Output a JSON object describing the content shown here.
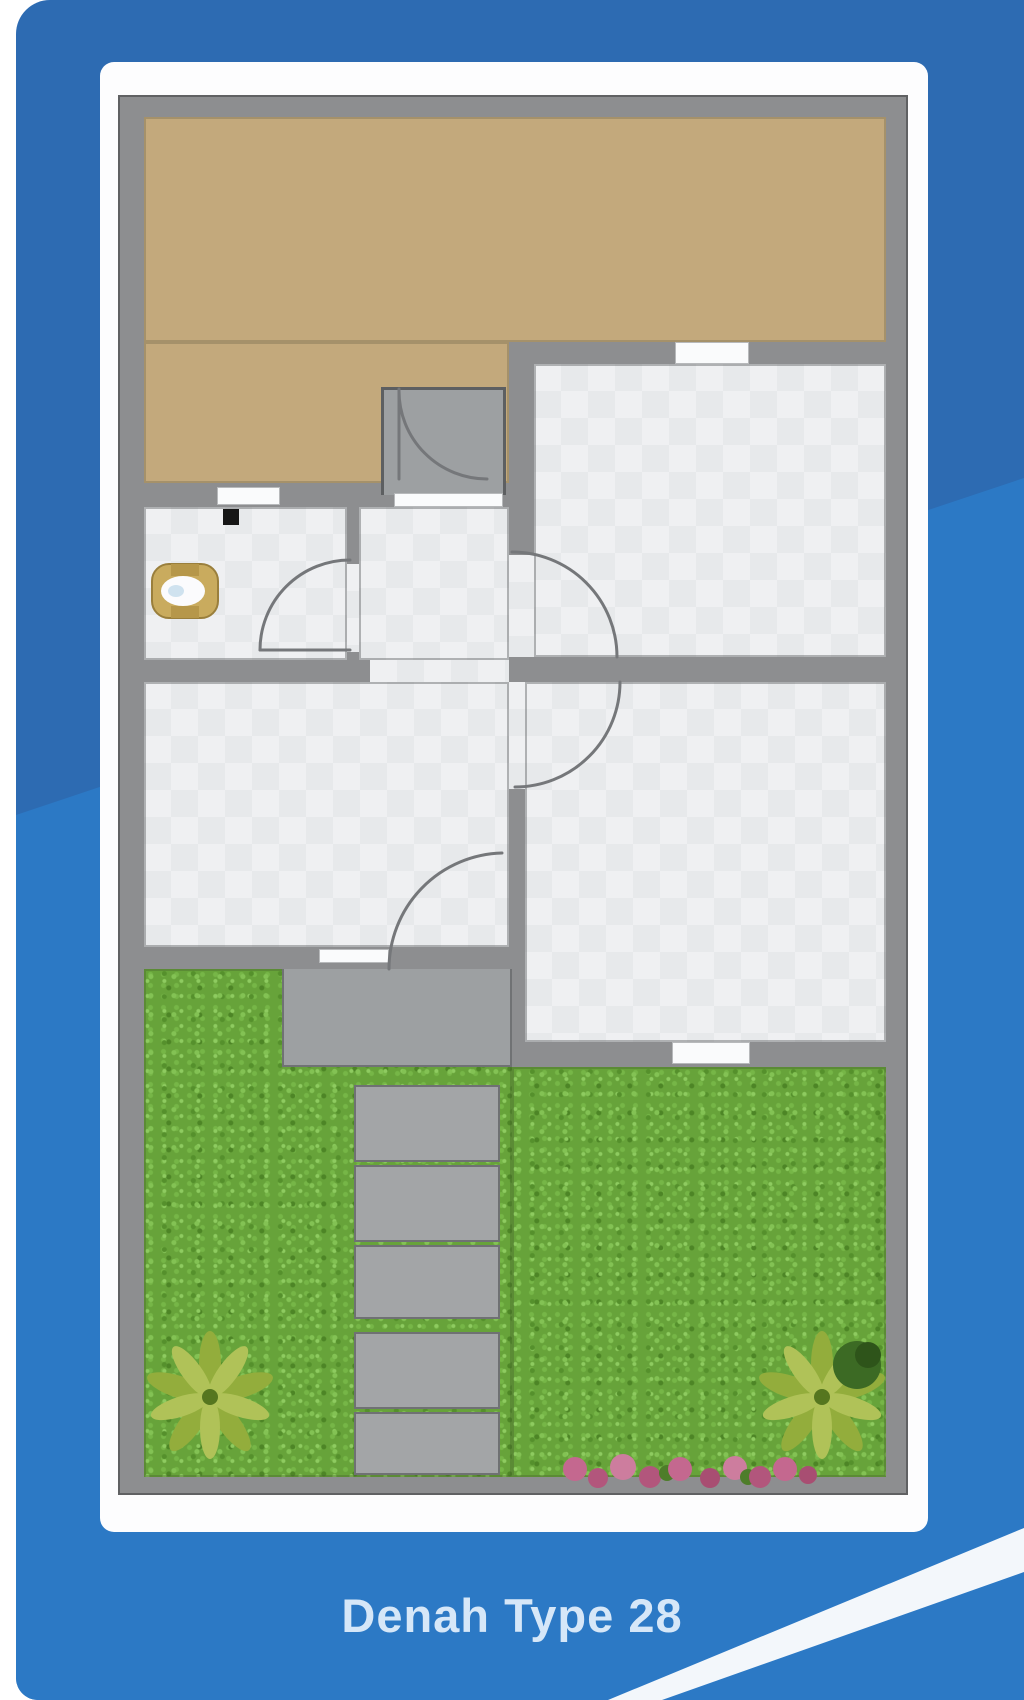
{
  "caption": {
    "label": "Denah Type 28"
  },
  "palette": {
    "background_blue_dark": "#2d6bb2",
    "background_blue_light": "#2c79c5",
    "swoosh_white": "#f3f7fb",
    "card_white": "#fdfdfe",
    "wall_gray": "#8d8e90",
    "wall_outline": "#606163",
    "carport_tan": "#c3a97c",
    "floor_tile": "#eff0f2",
    "porch_patio_gray": "#9da0a2",
    "stepping_stone_gray": "#a3a5a7",
    "grass_green": "#67a33a",
    "palm_green": "#9db544",
    "flower_pink": "#c4688f",
    "toilet_gold": "#c9ab5e",
    "caption_text": "#d6e7f8"
  },
  "plan": {
    "areas": [
      "carport",
      "porch",
      "bathroom",
      "hallway",
      "bedroom-top-right",
      "bedroom-bottom-right",
      "living-room",
      "patio",
      "garden-left",
      "garden-right"
    ],
    "garden_elements": [
      "stepping-stones",
      "palm-tree-left",
      "palm-tree-right",
      "bush",
      "flower-bed"
    ],
    "fixtures": [
      "toilet",
      "column-marker",
      "door-arcs",
      "windows"
    ]
  }
}
